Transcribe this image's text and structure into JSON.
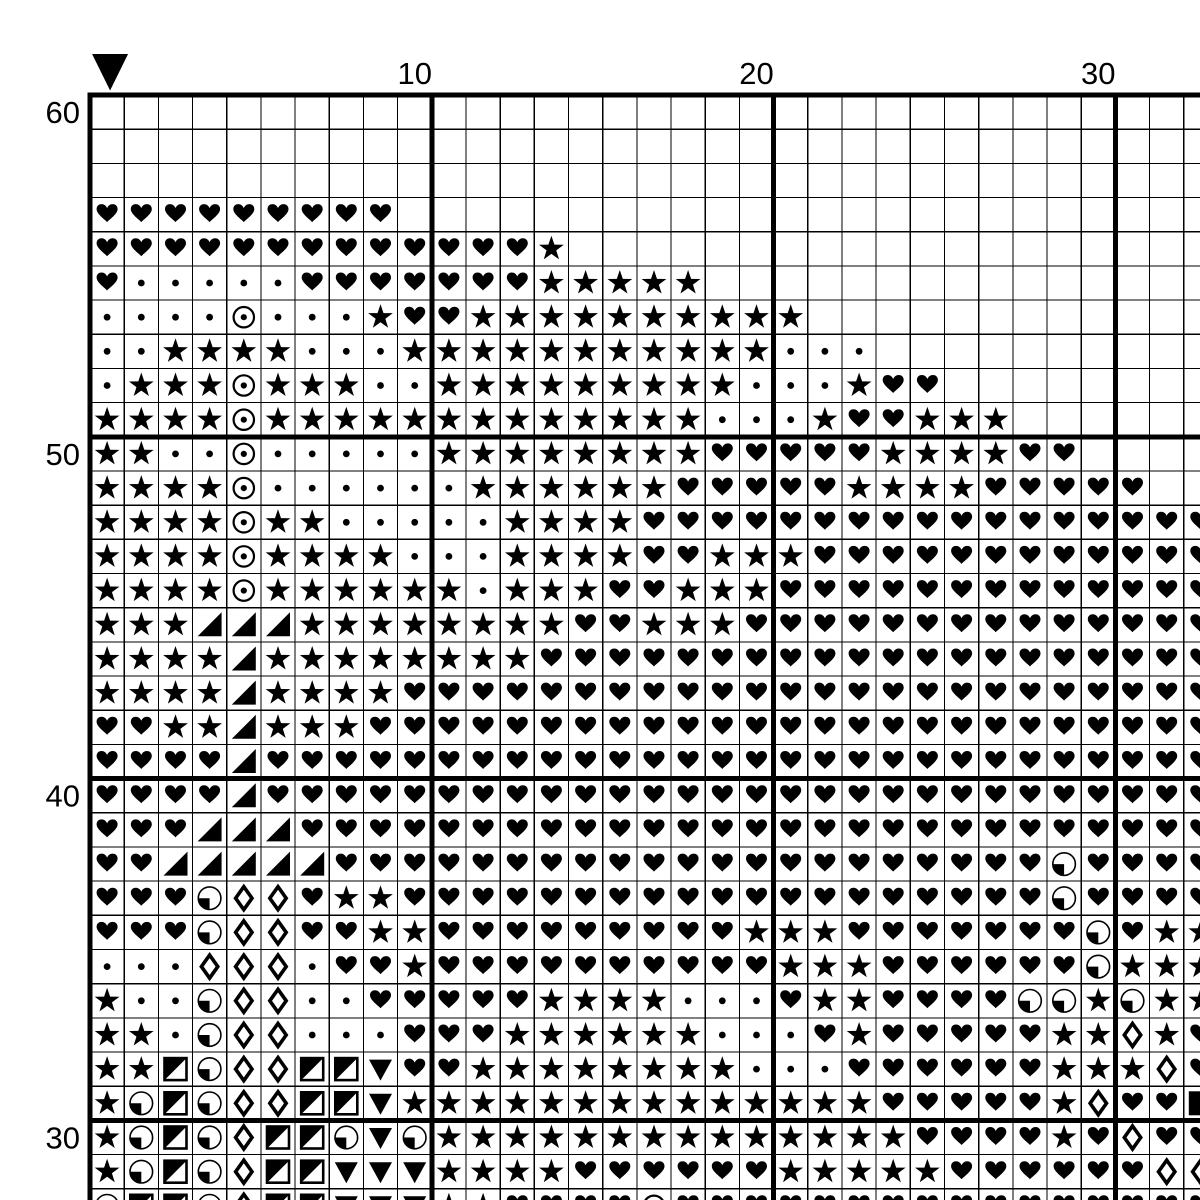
{
  "page": {
    "kind": "cross-stitch pattern chart",
    "background_color": "#ffffff",
    "ink_color": "#000000"
  },
  "chart_data": {
    "type": "heatmap",
    "grid": {
      "visible_cols": 33,
      "visible_rows": 33,
      "top_row_number": 60,
      "bottom_row_number": 28,
      "row_numbers_decrease_downward": true,
      "bold_line_every": 10,
      "grid_on": true
    },
    "col_labels": [
      {
        "text": "10",
        "col_index": 9
      },
      {
        "text": "20",
        "col_index": 19
      },
      {
        "text": "30",
        "col_index": 29
      }
    ],
    "row_labels": [
      {
        "text": "60",
        "row_index": 0
      },
      {
        "text": "50",
        "row_index": 10
      },
      {
        "text": "40",
        "row_index": 20
      },
      {
        "text": "30",
        "row_index": 30
      }
    ],
    "center_marker": {
      "symbol": "black-down-triangle",
      "above_col_index": 0
    },
    "symbol_legend": {
      ".": "empty",
      "H": "solid-heart",
      "S": "solid-star",
      "d": "small-dot",
      "O": "circle-with-center-dot",
      "T": "black-lower-right-triangle",
      "P": "circle-with-lower-left-quarter-black",
      "D": "open-diamond-thick-outline",
      "Q": "square-with-upper-left-diagonal-half-black",
      "V": "black-down-triangle",
      "B": "black-filled-square"
    },
    "rows": [
      {
        "row": 60,
        "cells": "................................."
      },
      {
        "row": 59,
        "cells": "................................."
      },
      {
        "row": 58,
        "cells": "................................."
      },
      {
        "row": 57,
        "cells": "HHHHHHHHH........................"
      },
      {
        "row": 56,
        "cells": "HHHHHHHHHHHHHS..................."
      },
      {
        "row": 55,
        "cells": "HdddddHHHHHHHSSSSS..............."
      },
      {
        "row": 54,
        "cells": "ddddOdddSHHSSSSSSSSSS............"
      },
      {
        "row": 53,
        "cells": "ddSSSSdddSSSSSSSSSSSddd.........."
      },
      {
        "row": 52,
        "cells": "dSSSOSSSddSSSSSSSSSdddSHH........"
      },
      {
        "row": 51,
        "cells": "SSSSOSSSSSSSSSSSSSdddSHHSSS......"
      },
      {
        "row": 50,
        "cells": "SSddOdddddSSSSSSSSHHHHHSSSSHH...."
      },
      {
        "row": 49,
        "cells": "SSSSOddddddSSSSSSHHHHHSSSSHHHHH.."
      },
      {
        "row": 48,
        "cells": "SSSSOSSdddddSSSSHHHHHHHHHHHHHHHHH"
      },
      {
        "row": 47,
        "cells": "SSSSOSSSSdddSSSSHHSSSHHHHHHHHHHHH"
      },
      {
        "row": 46,
        "cells": "SSSSOSSSSSSdSSSHHSSSHHHHHHHHHHHHH"
      },
      {
        "row": 45,
        "cells": "SSSTTTSSSSSSSSHHSSSHHHHHHHHHHHHHH"
      },
      {
        "row": 44,
        "cells": "SSSSTSSSSSSSSHHHHHHHHHHHHHHHHHHHH"
      },
      {
        "row": 43,
        "cells": "SSSSTSSSSHHHHHHHHHHHHHHHHHHHHHHHH"
      },
      {
        "row": 42,
        "cells": "HHSSTSSSHHHHHHHHHHHHHHHHHHHHHHHHH"
      },
      {
        "row": 41,
        "cells": "HHHHTHHHHHHHHHHHHHHHHHHHHHHHHHHHH"
      },
      {
        "row": 40,
        "cells": "HHHHTHHHHHHHHHHHHHHHHHHHHHHHHHHHH"
      },
      {
        "row": 39,
        "cells": "HHHTTTHHHHHHHHHHHHHHHHHHHHHHHHHHH"
      },
      {
        "row": 38,
        "cells": "HHTTTTTHHHHHHHHHHHHHHHHHHHHHPHHHH"
      },
      {
        "row": 37,
        "cells": "HHHPDDHSSHHHHHHHHHHHHHHHHHHHPHHHH"
      },
      {
        "row": 36,
        "cells": "HHHPDDHHSSHHHHHHHHHSSSHHHHHHHPHSS"
      },
      {
        "row": 35,
        "cells": "dddDDDdHHSHHHHHHHHHHSSSHHHHHHPSSS"
      },
      {
        "row": 34,
        "cells": "SddPDDddHHHHHSSSSdddHSSHHHHPPSPSS"
      },
      {
        "row": 33,
        "cells": "SSdPDDdddHHHSSSSSSdddHSHHHHHSSDSH"
      },
      {
        "row": 32,
        "cells": "SSQPDDQQVHHSSSSSSSSdddHHHHHHSSSDH"
      },
      {
        "row": 31,
        "cells": "SPQPDDQQVSSSSSSSSSSSSSSHHHHHSDHHB"
      },
      {
        "row": 30,
        "cells": "SPQPDQQPVPSSSSSSSSSSSSSSHHHHSHDHH"
      },
      {
        "row": 29,
        "cells": "SPQPDQQVVVSSSSHHHHHHSSSSSHHHHHHDD"
      },
      {
        "row": 28,
        "cells": "PQQPDQQVVVSSHHHHOHHHHHHHHHHHHHHHH"
      }
    ]
  }
}
